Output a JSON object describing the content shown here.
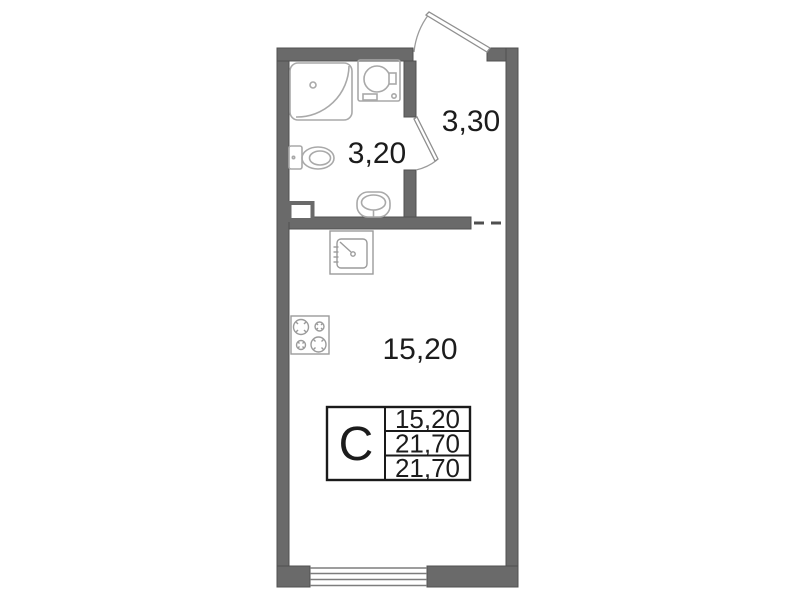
{
  "floor_plan": {
    "title": "studio-apartment-floor-plan",
    "rooms": {
      "bathroom": {
        "area": "3,20"
      },
      "hallway": {
        "area": "3,30"
      },
      "living_room": {
        "area": "15,20"
      }
    },
    "area_stamp": {
      "type_label": "С",
      "rows": [
        "15,20",
        "21,70",
        "21,70"
      ]
    },
    "fixtures": [
      "shower-cabin-icon",
      "washing-machine-icon",
      "toilet-icon",
      "bathroom-sink-icon",
      "kitchen-sink-icon",
      "stove-icon",
      "window-icon",
      "entrance-door-icon",
      "bathroom-door-icon"
    ],
    "colors": {
      "wall": "#6a6a6a",
      "fixture_line": "#a9a9a9",
      "kitchen_line": "#9b9b9b",
      "text": "#1c1c1c",
      "stamp_border": "#1a1a1a",
      "background": "#ffffff"
    }
  }
}
